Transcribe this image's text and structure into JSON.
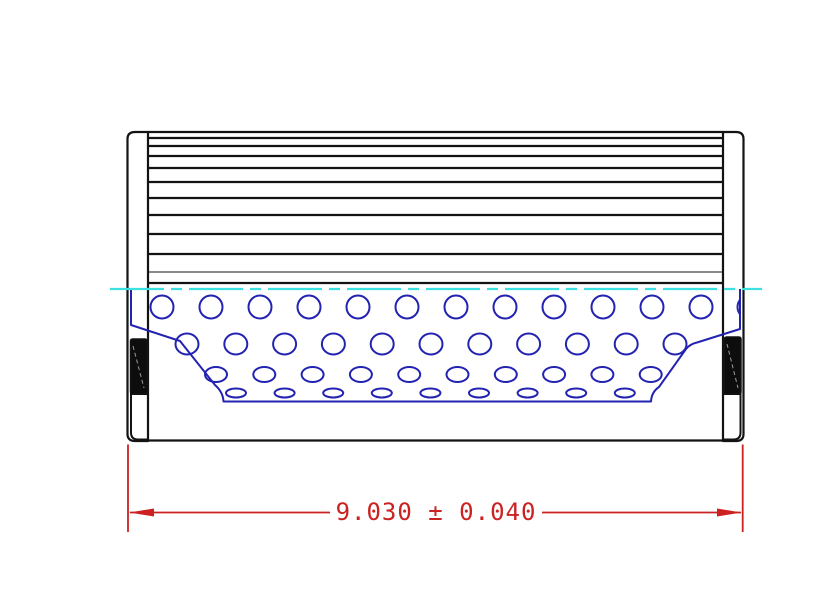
{
  "colors": {
    "outline": "#131313",
    "core_blue": "#2323b2",
    "centerline_cyan": "#3ddfe0",
    "dimension_red": "#cc2121",
    "cap_fill": "#ffffff",
    "seal_fill": "#0d0d0d",
    "seal_dash": "#9a9a9a",
    "background": "#ffffff"
  },
  "dimension": {
    "label": "9.030 ± 0.040",
    "value": "9.030",
    "tolerance": "0.040"
  },
  "drawing": {
    "canvas": {
      "width": 840,
      "height": 600
    },
    "body": {
      "left": 148,
      "right": 723,
      "top": 132,
      "pleat_bottom": 283,
      "bottom_line_y": 440.5
    },
    "pleat_lines": [
      {
        "y": 132,
        "w": 2.2
      },
      {
        "y": 138,
        "w": 2.2
      },
      {
        "y": 146,
        "w": 2.2
      },
      {
        "y": 156,
        "w": 2.2
      },
      {
        "y": 168,
        "w": 2.2
      },
      {
        "y": 182,
        "w": 2.2
      },
      {
        "y": 198,
        "w": 2.2
      },
      {
        "y": 215,
        "w": 2.2
      },
      {
        "y": 234,
        "w": 2.2
      },
      {
        "y": 254,
        "w": 2.2
      },
      {
        "y": 272,
        "w": 1
      },
      {
        "y": 283,
        "w": 2.2
      }
    ],
    "caps": {
      "left": {
        "name": "left-end-cap",
        "path": "M 148 132 L 135 132 Q 127.5 132 127.5 139 L 127.5 434 Q 127.5 441 135 441 L 148 441 Z"
      },
      "right": {
        "name": "right-end-cap",
        "path": "M 723 132 L 736 132 Q 743.5 132 743.5 139 L 743.5 434 Q 743.5 441 736 441 L 723 441 Z"
      }
    },
    "seals": {
      "left": {
        "name": "left-seal",
        "x": 130.5,
        "y": 339,
        "w": 16.5,
        "h": 55,
        "dash_line": {
          "x1": 133,
          "y1": 346,
          "x2": 144,
          "y2": 388
        }
      },
      "right": {
        "name": "right-seal",
        "x": 724.5,
        "y": 337,
        "w": 16.5,
        "h": 57,
        "dash_line": {
          "x1": 727,
          "y1": 344,
          "x2": 738,
          "y2": 388
        }
      }
    },
    "cap_pockets": {
      "left": {
        "name": "left-cap-pocket",
        "path": "M 148 394 L 131 394 L 131 432.5 Q 131 439.5 138 439.5 L 148 439.5 Z"
      },
      "right": {
        "name": "right-cap-pocket",
        "path": "M 723 394 L 740.5 394 L 740.5 432.5 Q 740.5 439.5 733.5 439.5 L 723 439.5 Z"
      }
    },
    "core": {
      "outline": "M 131 289 L 131 325 L 180 341 L 215 385 Q 223 392 223.5 401.5 L 651 401.5 Q 651.5 392 659 387 L 686 349 Q 690 344 697 342.5 L 740 329 L 740 289",
      "rows": [
        {
          "y": 307,
          "rx": 11.5,
          "ry": 11.5,
          "x_start": 162,
          "step": 49,
          "count": 12,
          "free_ends": false,
          "extra_x": [
            749
          ]
        },
        {
          "y": 344,
          "rx": 11.5,
          "ry": 10.5,
          "x_start": 187,
          "step": 48.8,
          "count": 11,
          "free_ends": true
        },
        {
          "y": 374.5,
          "rx": 11,
          "ry": 7.5,
          "x_start": 216,
          "step": 48.3,
          "count": 10,
          "free_ends": true
        },
        {
          "y": 393,
          "rx": 10,
          "ry": 4.5,
          "x_start": 236,
          "step": 48.6,
          "count": 9,
          "free_ends": false
        }
      ]
    },
    "centerline": {
      "y": 289,
      "x1": 110,
      "x2": 762,
      "w": 2.2,
      "dash": [
        54,
        7,
        11,
        7
      ]
    },
    "dim": {
      "ext_lines": [
        {
          "x": 128,
          "y1": 444.5,
          "y2": 532
        },
        {
          "x": 742.7,
          "y1": 444.5,
          "y2": 532
        }
      ],
      "line_y": 512.5,
      "segments": [
        {
          "x1": 130,
          "x2": 330
        },
        {
          "x1": 542,
          "x2": 741
        }
      ],
      "arrows": [
        "129,512.5 154,508.5 154,516.5",
        "741.7,512.5 717,508.5 717,516.5"
      ],
      "text_x": 436,
      "text_y": 520,
      "line_w": 1.8
    }
  }
}
